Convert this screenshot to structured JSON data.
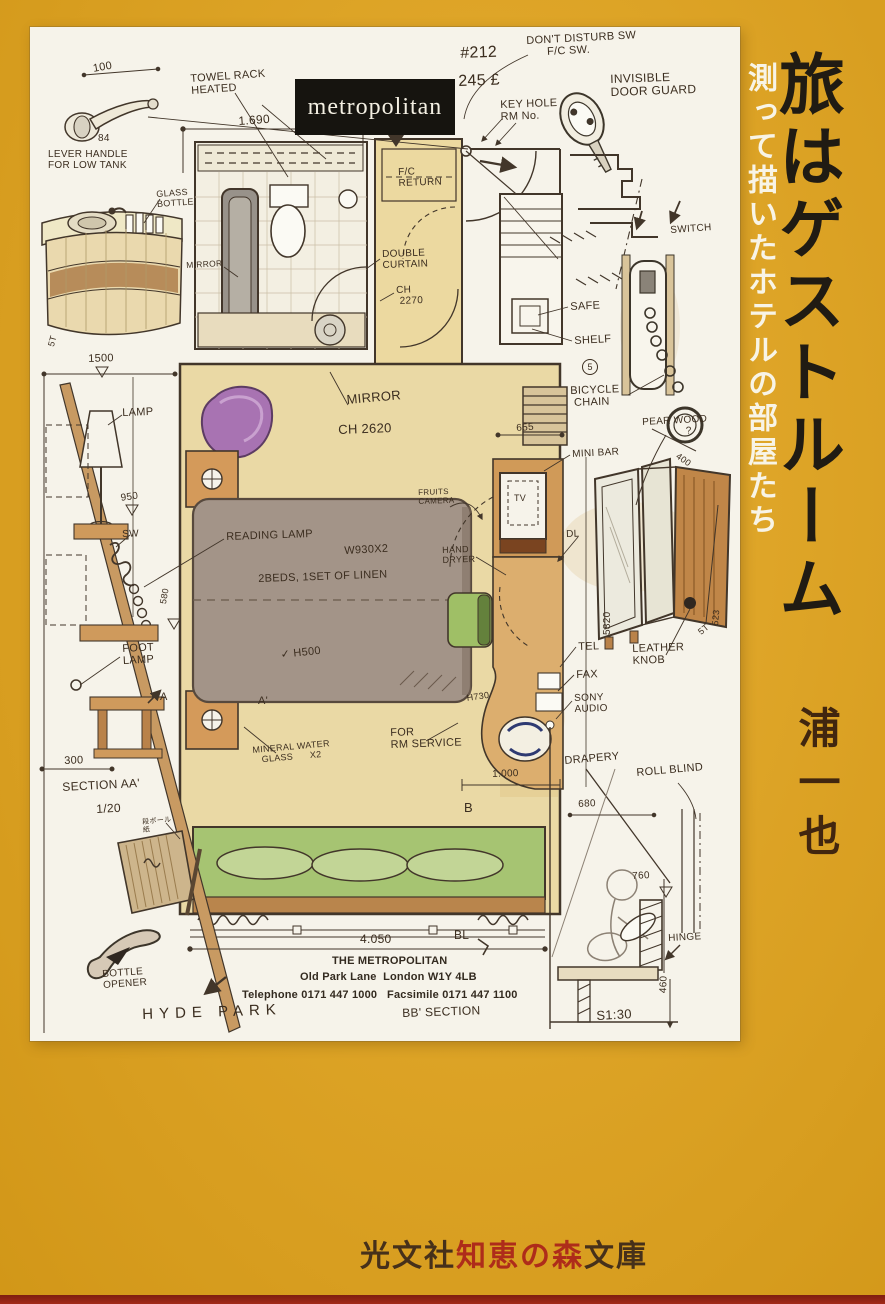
{
  "cover": {
    "title": "旅はゲストルーム",
    "subtitle": "測って描いたホテルの部屋たち",
    "author": "浦一也",
    "publisher": {
      "part1": "光文社",
      "part2": "知恵の森",
      "part3": "文庫"
    },
    "colors": {
      "cover_yellow": "#e2a41c",
      "ink": "#3b2d1f",
      "publisher_red": "#ae2c1a",
      "publisher_dark": "#46301a",
      "bottom_strip_red": "#8e2113",
      "paper": "#f6f3ea"
    }
  },
  "sketch": {
    "logo": "metropolitan",
    "labels": [
      {
        "name": "dim-100",
        "text": "100",
        "x": 62,
        "y": 36,
        "size": 11,
        "rot": -10
      },
      {
        "name": "dia-84",
        "text": "84",
        "x": 68,
        "y": 106,
        "size": 10
      },
      {
        "name": "label-lever-handle",
        "text": "LEVER HANDLE\nFOR LOW TANK",
        "x": 18,
        "y": 122,
        "size": 10
      },
      {
        "name": "label-glass-bottle",
        "text": "GLASS\nBOTTLE",
        "x": 126,
        "y": 162,
        "size": 9,
        "rot": -4
      },
      {
        "name": "label-towel-rack",
        "text": "TOWEL RACK\nHEATED",
        "x": 160,
        "y": 46,
        "size": 11,
        "rot": -4
      },
      {
        "name": "dim-1690",
        "text": "1.690",
        "x": 208,
        "y": 88,
        "size": 12,
        "rot": -4
      },
      {
        "name": "room-number",
        "text": "#212",
        "x": 430,
        "y": 18,
        "size": 16,
        "rot": -2
      },
      {
        "name": "room-rate",
        "text": "245 £",
        "x": 428,
        "y": 46,
        "size": 16,
        "rot": -2
      },
      {
        "name": "label-dont-disturb",
        "text": "DON'T DISTURB SW\n      F/C SW.",
        "x": 496,
        "y": 8,
        "size": 11,
        "rot": -3
      },
      {
        "name": "label-invisible-door-guard",
        "text": "INVISIBLE\nDOOR GUARD",
        "x": 580,
        "y": 46,
        "size": 12,
        "rot": -2
      },
      {
        "name": "label-key-hole",
        "text": "KEY HOLE\nRM No.",
        "x": 470,
        "y": 72,
        "size": 11,
        "rot": -2
      },
      {
        "name": "label-fc-return",
        "text": "F/C\nRETURN",
        "x": 368,
        "y": 140,
        "size": 10,
        "rot": -2
      },
      {
        "name": "label-switch",
        "text": "SWITCH",
        "x": 640,
        "y": 198,
        "size": 10,
        "rot": -4
      },
      {
        "name": "label-mirror-bath",
        "text": "MIRROR",
        "x": 156,
        "y": 234,
        "size": 8.5,
        "rot": -3
      },
      {
        "name": "label-double-curtain",
        "text": "DOUBLE\nCURTAIN",
        "x": 352,
        "y": 222,
        "size": 10,
        "rot": -2
      },
      {
        "name": "dim-ch2270",
        "text": "CH\n 2270",
        "x": 366,
        "y": 258,
        "size": 10,
        "rot": -2
      },
      {
        "name": "label-safe",
        "text": "SAFE",
        "x": 540,
        "y": 274,
        "size": 11,
        "rot": -3
      },
      {
        "name": "label-shelf",
        "text": "SHELF",
        "x": 544,
        "y": 308,
        "size": 11,
        "rot": -3
      },
      {
        "name": "shelf-count",
        "text": "5",
        "x": 552,
        "y": 332,
        "size": 9,
        "cls": "circled"
      },
      {
        "name": "label-bicycle-chain",
        "text": "BICYCLE\n CHAIN",
        "x": 540,
        "y": 358,
        "size": 11,
        "rot": -2
      },
      {
        "name": "label-pear-wood",
        "text": "PEAR WOOD\n              ?",
        "x": 612,
        "y": 390,
        "size": 10,
        "rot": -3
      },
      {
        "name": "dim-400",
        "text": "400",
        "x": 650,
        "y": 424,
        "size": 9,
        "rot": 35
      },
      {
        "name": "label-mini-bar",
        "text": "MINI BAR",
        "x": 542,
        "y": 422,
        "size": 10,
        "rot": -3
      },
      {
        "name": "label-tv",
        "text": "TV",
        "x": 484,
        "y": 466,
        "size": 9
      },
      {
        "name": "dim-655",
        "text": "655",
        "x": 486,
        "y": 396,
        "size": 10,
        "rot": -4
      },
      {
        "name": "label-mirror-room",
        "text": "MIRROR",
        "x": 316,
        "y": 366,
        "size": 13,
        "rot": -5
      },
      {
        "name": "dim-ch2620",
        "text": "CH 2620",
        "x": 308,
        "y": 396,
        "size": 13,
        "rot": -2
      },
      {
        "name": "label-reading-lamp",
        "text": "READING LAMP",
        "x": 196,
        "y": 504,
        "size": 11,
        "rot": -2
      },
      {
        "name": "dim-w930",
        "text": "W930X2",
        "x": 314,
        "y": 518,
        "size": 11,
        "rot": -3
      },
      {
        "name": "label-beds",
        "text": "2BEDS, 1SET OF LINEN",
        "x": 228,
        "y": 546,
        "size": 11,
        "rot": -2
      },
      {
        "name": "label-camera",
        "text": "FRUITS\nCAMERA",
        "x": 388,
        "y": 462,
        "size": 8,
        "rot": -2
      },
      {
        "name": "label-hand-dryer",
        "text": "HAND\nDRYER",
        "x": 412,
        "y": 518,
        "size": 9,
        "rot": -2
      },
      {
        "name": "label-dl",
        "text": "DL",
        "x": 536,
        "y": 502,
        "size": 10,
        "rot": -2
      },
      {
        "name": "dim-5820",
        "text": "5820",
        "x": 572,
        "y": 608,
        "size": 10,
        "rot": -90
      },
      {
        "name": "dim-523",
        "text": "523",
        "x": 680,
        "y": 598,
        "size": 9,
        "rot": -85
      },
      {
        "name": "note-5t-wardrobe",
        "text": "5T",
        "x": 666,
        "y": 602,
        "size": 9,
        "rot": -40
      },
      {
        "name": "label-leather-knob",
        "text": "LEATHER\nKNOB",
        "x": 602,
        "y": 616,
        "size": 11,
        "rot": -2
      },
      {
        "name": "label-tel",
        "text": "TEL",
        "x": 548,
        "y": 614,
        "size": 11,
        "rot": -2
      },
      {
        "name": "label-fax",
        "text": "FAX",
        "x": 546,
        "y": 642,
        "size": 11,
        "rot": -2
      },
      {
        "name": "label-sony-audio",
        "text": "SONY\nAUDIO",
        "x": 544,
        "y": 666,
        "size": 10,
        "rot": -2
      },
      {
        "name": "dim-h730",
        "text": "H730",
        "x": 436,
        "y": 666,
        "size": 9,
        "rot": -8
      },
      {
        "name": "label-h500",
        "text": "✓ H500",
        "x": 250,
        "y": 622,
        "size": 11,
        "rot": -6
      },
      {
        "name": "label-for-rm-service",
        "text": "FOR\nRM SERVICE",
        "x": 360,
        "y": 700,
        "size": 11,
        "rot": -2
      },
      {
        "name": "label-mineral-water",
        "text": "MINERAL WATER\n   GLASS      X2",
        "x": 222,
        "y": 718,
        "size": 9,
        "rot": -5
      },
      {
        "name": "mark-a",
        "text": "A",
        "x": 130,
        "y": 664,
        "size": 11
      },
      {
        "name": "mark-a-prime",
        "text": "A'",
        "x": 228,
        "y": 668,
        "size": 11
      },
      {
        "name": "dim-1000",
        "text": "1.000",
        "x": 462,
        "y": 742,
        "size": 10,
        "rot": -2
      },
      {
        "name": "mark-b",
        "text": "B",
        "x": 434,
        "y": 774,
        "size": 13
      },
      {
        "name": "mark-bl",
        "text": "BL",
        "x": 424,
        "y": 902,
        "size": 12
      },
      {
        "name": "note-5t-left",
        "text": "5T",
        "x": 16,
        "y": 318,
        "size": 9,
        "rot": -75
      },
      {
        "name": "dim-1500",
        "text": "1500",
        "x": 58,
        "y": 326,
        "size": 11,
        "rot": -2
      },
      {
        "name": "label-lamp",
        "text": "LAMP",
        "x": 92,
        "y": 380,
        "size": 11,
        "rot": -2
      },
      {
        "name": "dim-950",
        "text": "950",
        "x": 90,
        "y": 466,
        "size": 10,
        "rot": -8
      },
      {
        "name": "label-sw",
        "text": "SW",
        "x": 92,
        "y": 502,
        "size": 10,
        "rot": -2
      },
      {
        "name": "dim-580",
        "text": "580",
        "x": 128,
        "y": 576,
        "size": 9,
        "rot": -80
      },
      {
        "name": "label-foot-lamp",
        "text": "FOOT\nLAMP",
        "x": 92,
        "y": 616,
        "size": 11,
        "rot": -3
      },
      {
        "name": "dim-300",
        "text": "300",
        "x": 34,
        "y": 728,
        "size": 11,
        "rot": -2
      },
      {
        "name": "label-section-aa",
        "text": "SECTION AA'",
        "x": 32,
        "y": 754,
        "size": 12,
        "rot": -3
      },
      {
        "name": "label-scale-aa",
        "text": "1/20",
        "x": 66,
        "y": 776,
        "size": 12,
        "rot": -3
      },
      {
        "name": "note-cardboard",
        "text": "段ボール\n紙",
        "x": 112,
        "y": 792,
        "size": 7,
        "rot": -5
      },
      {
        "name": "label-bottle-opener",
        "text": "BOTTLE\nOPENER",
        "x": 72,
        "y": 942,
        "size": 10,
        "rot": -4
      },
      {
        "name": "label-hyde-park",
        "text": "HYDE PARK",
        "x": 112,
        "y": 980,
        "size": 15,
        "rot": -2,
        "cls": "wide"
      },
      {
        "name": "dim-4050",
        "text": "4.050",
        "x": 330,
        "y": 906,
        "size": 12
      },
      {
        "name": "hotel-name",
        "text": "THE METROPOLITAN",
        "x": 302,
        "y": 928,
        "size": 11,
        "cls": "print printbold"
      },
      {
        "name": "hotel-address",
        "text": "Old Park Lane  London W1Y 4LB",
        "x": 270,
        "y": 944,
        "size": 11,
        "cls": "print printbold"
      },
      {
        "name": "hotel-phone",
        "text": "Telephone 0171 447 1000   Facsimile 0171 447 1100",
        "x": 212,
        "y": 962,
        "size": 11,
        "cls": "print printbold"
      },
      {
        "name": "label-bb-section",
        "text": "BB' SECTION",
        "x": 372,
        "y": 980,
        "size": 12,
        "rot": -2
      },
      {
        "name": "label-drapery",
        "text": "DRAPERY",
        "x": 534,
        "y": 728,
        "size": 11,
        "rot": -5
      },
      {
        "name": "label-roll-blind",
        "text": "ROLL BLIND",
        "x": 606,
        "y": 740,
        "size": 11,
        "rot": -5
      },
      {
        "name": "dim-680",
        "text": "680",
        "x": 548,
        "y": 772,
        "size": 10,
        "rot": -3
      },
      {
        "name": "dim-760",
        "text": "760",
        "x": 602,
        "y": 844,
        "size": 10,
        "rot": -3
      },
      {
        "name": "label-hinge",
        "text": "HINGE",
        "x": 638,
        "y": 906,
        "size": 10,
        "rot": -3
      },
      {
        "name": "dim-460",
        "text": "460",
        "x": 628,
        "y": 966,
        "size": 10,
        "rot": -88
      },
      {
        "name": "label-scale-bb",
        "text": "S1:30",
        "x": 566,
        "y": 982,
        "size": 13,
        "rot": -3
      }
    ]
  }
}
